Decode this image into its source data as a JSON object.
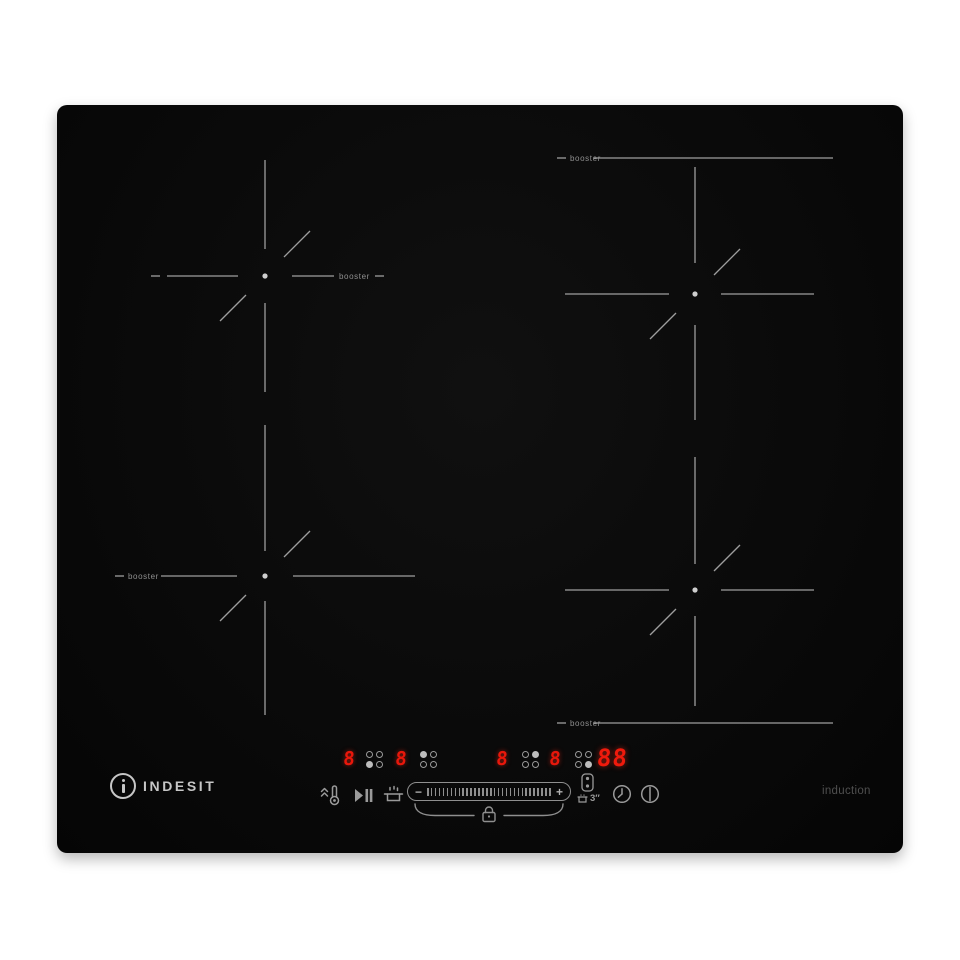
{
  "device": {
    "brand": {
      "icon_letter": "i",
      "name": "INDESIT"
    },
    "type_label": "induction",
    "boosters": [
      "booster",
      "booster",
      "booster",
      "booster"
    ],
    "displays": [
      {
        "value": "8",
        "dots": [
          0,
          0,
          1,
          0
        ]
      },
      {
        "value": "8",
        "dots": [
          1,
          0,
          0,
          0
        ]
      },
      {
        "value": "8",
        "dots": [
          0,
          1,
          0,
          0
        ]
      },
      {
        "value": "8",
        "dots": [
          0,
          0,
          0,
          1
        ]
      }
    ],
    "timer_value": "88",
    "controls": {
      "slider": {
        "minus": "−",
        "plus": "+",
        "ticks": 32
      },
      "flexi_duration": "3″",
      "icons": [
        "heat-up-thermometer",
        "play-pause",
        "melt-pot",
        "power-slider",
        "child-lock",
        "flexi-zone",
        "timer-clock",
        "power"
      ]
    },
    "colors": {
      "led": "#e8170b",
      "lines": "#9e9e9e",
      "logo": "#c6c6c6",
      "body": "#0a0a0a"
    }
  }
}
